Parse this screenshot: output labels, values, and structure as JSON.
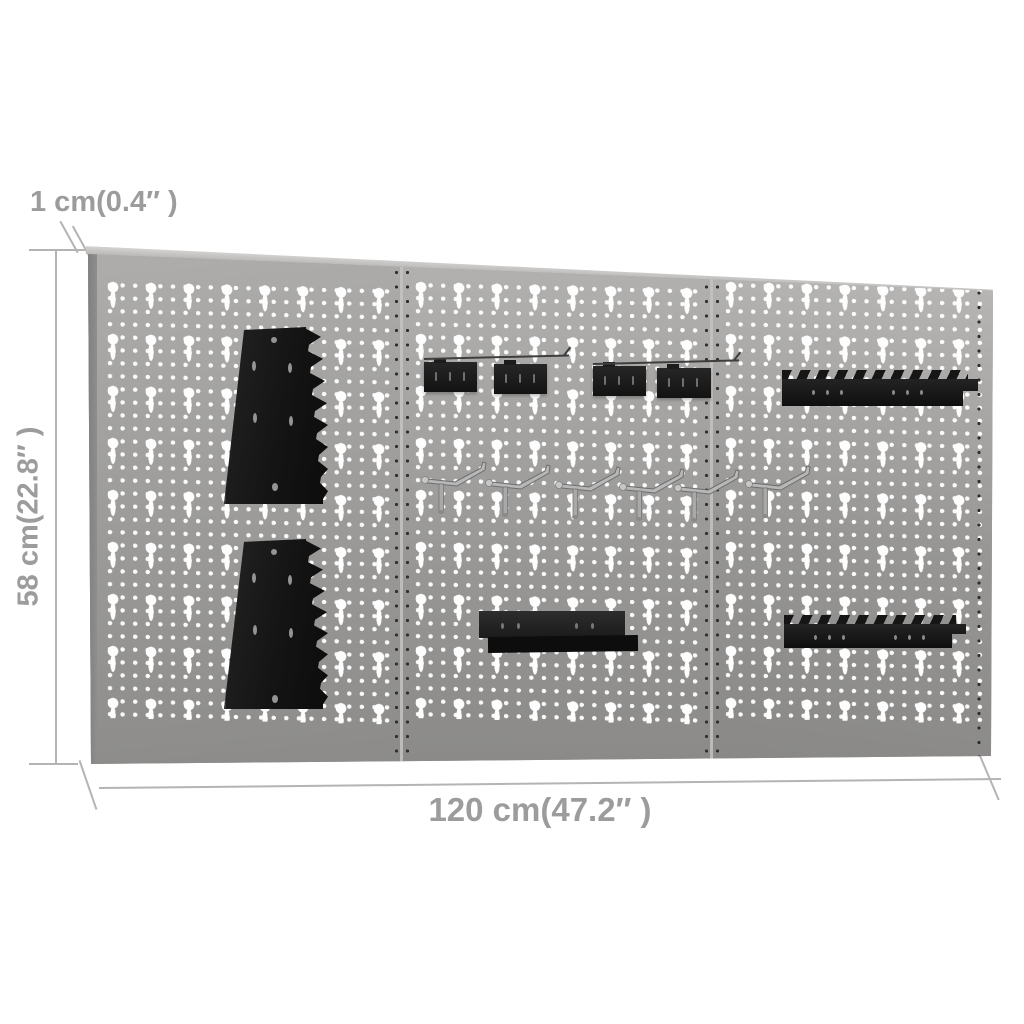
{
  "title": "Wall-mounted pegboard panels dimension diagram",
  "dimensions": {
    "thickness_label": "1 cm(0.4″ )",
    "height_label": "58 cm(22.8″ )",
    "width_label": "120 cm(47.2″ )"
  },
  "board": {
    "panel_count": 3,
    "accessories": [
      {
        "name": "trapezoid-wrench-rack-upper"
      },
      {
        "name": "trapezoid-wrench-rack-lower"
      },
      {
        "name": "clip-bracket-1"
      },
      {
        "name": "clip-bracket-2"
      },
      {
        "name": "clip-bracket-3"
      },
      {
        "name": "clip-bracket-4"
      },
      {
        "name": "pegboard-hook-1"
      },
      {
        "name": "pegboard-hook-2"
      },
      {
        "name": "pegboard-hook-3"
      },
      {
        "name": "pegboard-hook-4"
      },
      {
        "name": "pegboard-hook-5"
      },
      {
        "name": "pegboard-hook-6"
      },
      {
        "name": "small-shelf"
      },
      {
        "name": "screwdriver-rack-upper"
      },
      {
        "name": "screwdriver-rack-lower"
      }
    ]
  },
  "colors": {
    "annotation_text": "#9c9c9c",
    "dimension_line": "#b4b4b4",
    "panel_gray": "#a3a2a0",
    "panel_edge": "#c9c8c6",
    "accessory_black": "#1a1a1a",
    "hook_chrome": "#b5b5b5",
    "background": "#ffffff"
  }
}
